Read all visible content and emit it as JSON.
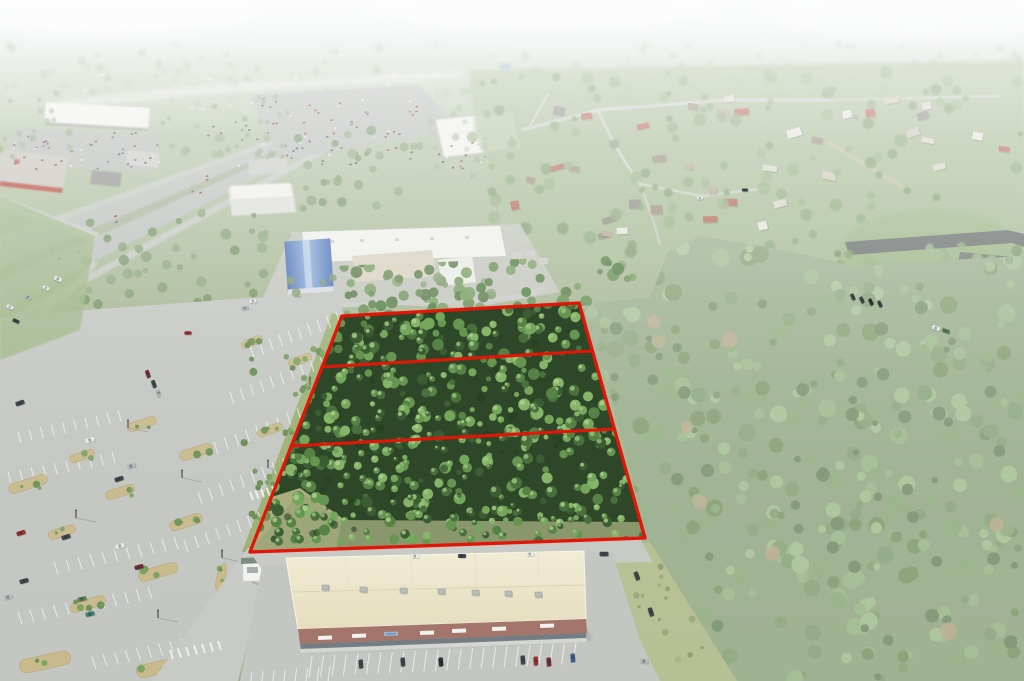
{
  "meta": {
    "kind": "aerial-drone-photograph",
    "subject": "wooded commercial land parcels outlined in red beside retail development and pine forest",
    "width_px": 1024,
    "height_px": 681,
    "parcel_count": 3
  },
  "palette": {
    "bg_sky": "#eef1f2",
    "bg_sky2": "#e6eaeb",
    "bg_dist": "#ccd6c5",
    "bg_mid": "#b2c2a5",
    "bg_green": "#a8b795",
    "bg_green2": "#a2b18d",
    "haze": "#ffffff",
    "city_white": "#e9eae6",
    "highway": "#bcc0bc",
    "median_green": "#a7b49a",
    "road_light": "#c7cac5",
    "lot": "#c3c6c1",
    "stripe": "#f0f2ef",
    "roof_white": "#eff0eb",
    "roof_gray": "#c9cbc6",
    "roof_dark": "#90928f",
    "bldg_mid": "#dcded8",
    "lowes_roof": "#c7c3ba",
    "lowes_red": "#b5483a",
    "blue_roof1": "#4f74b8",
    "blue_roof2": "#93b2dc",
    "school_taupe": "#d8d2c0",
    "apt_roof": "#6e7573",
    "apt_roof2": "#777e7b",
    "bldg_white": "#edeeea",
    "res_wash": "#a9bc97",
    "res_road": "#cbd0c8",
    "dirt_road": "#c4c0a4",
    "forest_base": "#8aa17a",
    "forest_dark": "#66815a",
    "forest_tan": "#b2a381",
    "parcel_base": "#2e4729",
    "parcel_dark": "#243c20",
    "clearing": "#a9ae7f",
    "clearing_dirt": "#c2bc95",
    "verge": "#9db177",
    "mulch": "#c9ba8e",
    "mulch_edge": "#b7a87c",
    "bush": "#6d8f54",
    "bush2": "#7ba15e",
    "scrub": "#b7c095",
    "grass": "#9cb786",
    "mall_roof_light": "#f2ecd6",
    "mall_roof_dark": "#e5ddbe",
    "mall_ridge": "#dcd3b2",
    "brick": "#a4756a",
    "storefront": "#6a747c",
    "sidewalk": "#d3d6d1",
    "sign_white": "#f2f2ee",
    "sign_roof": "#7c8a80",
    "shadow": "#8e938e",
    "pole": "#4a4f4a",
    "pole_shadow": "#8f948f",
    "hvac": "#b9bdb9"
  },
  "parcels": {
    "outline_color": "#e31507",
    "stroke_width": 3.3,
    "outline_points": "342,316 579,303 645,538 250,552",
    "divider1_points": "322,367 592,351",
    "divider2_points": "291,446 614,429",
    "band_clip_points": "322,318 332,266 648,254 662,302 580,306 342,316",
    "forest_clip_points": "577,312 600,302 650,298 668,252 700,236 772,248 852,266 908,262 1024,256 1024,681 737,681 648,543 630,470 607,380 585,340",
    "scrub_clip_points": "598,548 650,542 737,681 612,681"
  },
  "tree_palettes": {
    "hazy": [
      "#9db395",
      "#a6b89d",
      "#94ab8c"
    ],
    "upper": [
      "#8fa37f",
      "#97ab86",
      "#88a477"
    ],
    "mid": [
      "#7f9a6e",
      "#88a477",
      "#6d8f5c"
    ],
    "residential": [
      "#8aa678",
      "#93b081",
      "#7d9a6c"
    ],
    "band": [
      "#5e7f4d",
      "#6b8f58",
      "#7aa063",
      "#548047"
    ],
    "forest": [
      "#7d9a6c",
      "#85a473",
      "#92b07f",
      "#9cba88",
      "#74905f"
    ],
    "parcel": [
      "#3c5c33",
      "#49703c",
      "#568245",
      "#659551",
      "#74a65c",
      "#86b56a"
    ],
    "parcel_light": [
      "#9cc47d",
      "#aed28c"
    ],
    "scrub_dots": [
      "#9aa678",
      "#8f9c6d",
      "#a8b285"
    ]
  },
  "generated": {
    "seed": 7,
    "tree_regions": [
      {
        "layer": "trees-distant",
        "x": 0,
        "y": 44,
        "w": 1024,
        "h": 70,
        "n": 150,
        "rmin": 2,
        "rmax": 4.5,
        "pal": "hazy",
        "op": 0.5
      },
      {
        "layer": "trees-ul",
        "x": 150,
        "y": 92,
        "w": 140,
        "h": 65,
        "n": 28,
        "rmin": 2,
        "rmax": 4,
        "pal": "upper",
        "op": 0.75
      },
      {
        "layer": "trees-ul",
        "x": 0,
        "y": 92,
        "w": 70,
        "h": 70,
        "n": 16,
        "rmin": 2,
        "rmax": 4,
        "pal": "upper",
        "op": 0.75
      },
      {
        "layer": "trees-ul",
        "x": 420,
        "y": 108,
        "w": 100,
        "h": 70,
        "n": 15,
        "rmin": 2,
        "rmax": 4,
        "pal": "hazy",
        "op": 0.6
      },
      {
        "layer": "trees-mid",
        "x": 55,
        "y": 205,
        "w": 260,
        "h": 100,
        "n": 40,
        "rmin": 2.5,
        "rmax": 5.5,
        "pal": "mid",
        "op": 0.8
      },
      {
        "layer": "trees-mid",
        "x": 295,
        "y": 128,
        "w": 140,
        "h": 85,
        "n": 26,
        "rmin": 2.5,
        "rmax": 5,
        "pal": "mid",
        "op": 0.8
      },
      {
        "layer": "trees-school",
        "x": 245,
        "y": 275,
        "w": 320,
        "h": 45,
        "n": 26,
        "rmin": 3,
        "rmax": 6,
        "pal": "mid",
        "op": 0.85
      },
      {
        "layer": "trees-res",
        "x": 472,
        "y": 72,
        "w": 552,
        "h": 195,
        "n": 130,
        "rmin": 2.5,
        "rmax": 6.5,
        "pal": "residential",
        "op": 0.8
      },
      {
        "layer": "trees-apt",
        "x": 835,
        "y": 245,
        "w": 190,
        "h": 95,
        "n": 24,
        "rmin": 3,
        "rmax": 6,
        "pal": "forest",
        "op": 0.85
      },
      {
        "layer": "band-trees",
        "x": 325,
        "y": 258,
        "w": 330,
        "h": 60,
        "n": 80,
        "rmin": 3,
        "rmax": 6.5,
        "pal": "band",
        "op": 0.95
      },
      {
        "layer": "forest-trees",
        "x": 575,
        "y": 236,
        "w": 449,
        "h": 445,
        "n": 380,
        "rmin": 3.5,
        "rmax": 9,
        "pal": "forest",
        "op": 1
      },
      {
        "layer": "forest-trees",
        "x": 600,
        "y": 300,
        "w": 424,
        "h": 380,
        "n": 60,
        "rmin": 3,
        "rmax": 7,
        "pal": [
          "#66815a"
        ],
        "op": 0.9
      },
      {
        "layer": "forest-trees",
        "x": 640,
        "y": 300,
        "w": 384,
        "h": 360,
        "n": 8,
        "rmin": 5,
        "rmax": 9,
        "pal": [
          "#b2a381"
        ],
        "op": 0.8
      },
      {
        "layer": "verge-trees",
        "x": 240,
        "y": 330,
        "w": 100,
        "h": 215,
        "n": 16,
        "rmin": 2,
        "rmax": 4.5,
        "pal": [
          "#5f8449",
          "#6d9555"
        ],
        "op": 0.9
      },
      {
        "layer": "scrub-dots",
        "x": 598,
        "y": 548,
        "w": 150,
        "h": 130,
        "n": 45,
        "rmin": 1.5,
        "rmax": 3.5,
        "pal": "scrub_dots",
        "op": 0.9
      },
      {
        "layer": "parcel-trees",
        "x": 248,
        "y": 300,
        "w": 400,
        "h": 242,
        "n": 640,
        "rmin": 2.5,
        "rmax": 6,
        "pal": "parcel",
        "op": 1,
        "highlight": "parcel_light"
      }
    ],
    "city_specks": {
      "x": 55,
      "y": 72,
      "w": 380,
      "h": 45,
      "n": 26,
      "colors": [
        "#e9eae6",
        "#dfe0da",
        "#d4d6cf"
      ]
    },
    "lot_specks": [
      {
        "x": 10,
        "y": 130,
        "w": 148,
        "h": 40,
        "n": 55
      },
      {
        "x": 255,
        "y": 98,
        "w": 165,
        "h": 68,
        "n": 85
      },
      {
        "x": 425,
        "y": 132,
        "w": 88,
        "h": 36,
        "n": 26
      },
      {
        "x": 205,
        "y": 120,
        "w": 45,
        "h": 22,
        "n": 12
      }
    ],
    "speck_colors": [
      "#3f4345",
      "#b6babc",
      "#e9eae8",
      "#5b6065",
      "#993030"
    ],
    "traffic": {
      "n": 30,
      "x1": 8,
      "y1": 274,
      "x2": 400,
      "y2": 99,
      "spread": 14
    },
    "stripe_rows": [
      {
        "x1": 250,
        "y1": 346,
        "x2": 336,
        "y2": 312,
        "n": 10,
        "sx": 4,
        "sy": 12
      },
      {
        "x1": 230,
        "y1": 392,
        "x2": 330,
        "y2": 352,
        "n": 11,
        "sx": 4,
        "sy": 12
      },
      {
        "x1": 214,
        "y1": 442,
        "x2": 318,
        "y2": 400,
        "n": 11,
        "sx": 4,
        "sy": 12
      },
      {
        "x1": 198,
        "y1": 492,
        "x2": 304,
        "y2": 450,
        "n": 11,
        "sx": 4,
        "sy": 12
      },
      {
        "x1": 184,
        "y1": 540,
        "x2": 258,
        "y2": 512,
        "n": 8,
        "sx": 4,
        "sy": 12
      },
      {
        "x1": 18,
        "y1": 432,
        "x2": 118,
        "y2": 410,
        "n": 10,
        "sx": 3,
        "sy": 11
      },
      {
        "x1": 8,
        "y1": 472,
        "x2": 112,
        "y2": 452,
        "n": 10,
        "sx": 3,
        "sy": 11
      },
      {
        "x1": 54,
        "y1": 562,
        "x2": 174,
        "y2": 537,
        "n": 11,
        "sx": 4,
        "sy": 12
      },
      {
        "x1": 18,
        "y1": 612,
        "x2": 148,
        "y2": 587,
        "n": 12,
        "sx": 4,
        "sy": 12
      },
      {
        "x1": 92,
        "y1": 657,
        "x2": 214,
        "y2": 632,
        "n": 12,
        "sx": 4,
        "sy": 12
      },
      {
        "x1": 312,
        "y1": 656,
        "x2": 576,
        "y2": 643,
        "n": 24,
        "sx": -3,
        "sy": 21
      },
      {
        "x1": 252,
        "y1": 672,
        "x2": 330,
        "y2": 666,
        "n": 8,
        "sx": -2,
        "sy": 16
      }
    ],
    "crosswalks": [
      {
        "x1": 170,
        "y1": 650,
        "x2": 218,
        "y2": 641,
        "n": 7,
        "sx": 3,
        "sy": 9
      },
      {
        "x1": 250,
        "y1": 492,
        "x2": 272,
        "y2": 486,
        "n": 5,
        "sx": 3,
        "sy": 8
      },
      {
        "x1": 612,
        "y1": 638,
        "x2": 646,
        "y2": 633,
        "n": 6,
        "sx": 2,
        "sy": 8
      },
      {
        "x1": 412,
        "y1": 672,
        "x2": 428,
        "y2": 652,
        "n": 5,
        "sx": 9,
        "sy": 5
      },
      {
        "x1": 486,
        "y1": 670,
        "x2": 500,
        "y2": 650,
        "n": 5,
        "sx": 9,
        "sy": 5
      }
    ],
    "islands": [
      {
        "x": 142,
        "y": 424,
        "w": 30,
        "h": 9,
        "rot": -18
      },
      {
        "x": 196,
        "y": 452,
        "w": 34,
        "h": 10,
        "rot": -18
      },
      {
        "x": 82,
        "y": 456,
        "w": 26,
        "h": 8,
        "rot": -18
      },
      {
        "x": 28,
        "y": 484,
        "w": 40,
        "h": 10,
        "rot": -18
      },
      {
        "x": 120,
        "y": 492,
        "w": 30,
        "h": 9,
        "rot": -18
      },
      {
        "x": 186,
        "y": 522,
        "w": 34,
        "h": 10,
        "rot": -18
      },
      {
        "x": 62,
        "y": 532,
        "w": 28,
        "h": 9,
        "rot": -18
      },
      {
        "x": 158,
        "y": 572,
        "w": 40,
        "h": 11,
        "rot": -16
      },
      {
        "x": 88,
        "y": 604,
        "w": 36,
        "h": 10,
        "rot": -16
      },
      {
        "x": 45,
        "y": 662,
        "w": 52,
        "h": 14,
        "rot": -12
      },
      {
        "x": 158,
        "y": 668,
        "w": 44,
        "h": 13,
        "rot": -12
      },
      {
        "x": 234,
        "y": 618,
        "w": 30,
        "h": 10,
        "rot": -20
      },
      {
        "x": 270,
        "y": 430,
        "w": 26,
        "h": 8,
        "rot": -20
      },
      {
        "x": 300,
        "y": 360,
        "w": 24,
        "h": 8,
        "rot": -20
      },
      {
        "x": 252,
        "y": 342,
        "w": 22,
        "h": 8,
        "rot": -20
      },
      {
        "x": 205,
        "y": 628,
        "w": 9,
        "h": 30,
        "rot": 16
      },
      {
        "x": 221,
        "y": 577,
        "w": 8,
        "h": 28,
        "rot": 16
      },
      {
        "x": 583,
        "y": 658,
        "w": 22,
        "h": 12,
        "rot": 4
      }
    ],
    "bush_rows": [
      {
        "x": 300,
        "y": 390,
        "n": 5,
        "spread": 9
      },
      {
        "x": 285,
        "y": 430,
        "n": 4,
        "spread": 8
      },
      {
        "x": 268,
        "y": 480,
        "n": 4,
        "spread": 8
      },
      {
        "x": 256,
        "y": 515,
        "n": 4,
        "spread": 7
      },
      {
        "x": 318,
        "y": 350,
        "n": 4,
        "spread": 7
      },
      {
        "x": 316,
        "y": 648,
        "n": 3,
        "spread": 5
      },
      {
        "x": 340,
        "y": 647,
        "n": 3,
        "spread": 5
      },
      {
        "x": 365,
        "y": 646,
        "n": 3,
        "spread": 5
      },
      {
        "x": 390,
        "y": 645,
        "n": 3,
        "spread": 5
      },
      {
        "x": 415,
        "y": 644,
        "n": 3,
        "spread": 5
      },
      {
        "x": 440,
        "y": 643,
        "n": 3,
        "spread": 5
      },
      {
        "x": 465,
        "y": 642,
        "n": 3,
        "spread": 5
      },
      {
        "x": 490,
        "y": 641,
        "n": 3,
        "spread": 5
      },
      {
        "x": 515,
        "y": 640,
        "n": 3,
        "spread": 5
      },
      {
        "x": 540,
        "y": 639,
        "n": 3,
        "spread": 5
      },
      {
        "x": 560,
        "y": 638,
        "n": 3,
        "spread": 5
      }
    ],
    "poles": [
      {
        "x": 128,
        "y": 428
      },
      {
        "x": 182,
        "y": 478
      },
      {
        "x": 76,
        "y": 518
      },
      {
        "x": 158,
        "y": 618
      },
      {
        "x": 222,
        "y": 558
      },
      {
        "x": 310,
        "y": 385
      },
      {
        "x": 268,
        "y": 468
      },
      {
        "x": 254,
        "y": 602
      }
    ],
    "houses": {
      "regions": [
        {
          "x": 505,
          "y": 88,
          "w": 300,
          "h": 115,
          "n": 18
        },
        {
          "x": 812,
          "y": 96,
          "w": 200,
          "h": 78,
          "n": 12
        },
        {
          "x": 560,
          "y": 182,
          "w": 230,
          "h": 58,
          "n": 8
        }
      ],
      "colors": [
        "#e9e7e1",
        "#d9d6cd",
        "#cfc9ba",
        "#b6a795",
        "#9c8e7e",
        "#b5685a",
        "#8c8c84"
      ]
    }
  },
  "vehicles": {
    "car_colors": {
      "red": "#993030",
      "maroon": "#702f38",
      "dark": "#41464a",
      "black": "#2c2f33",
      "white": "#e9eae8",
      "silver": "#b6babc",
      "blue": "#3f5c8f",
      "teal": "#3f7f6e",
      "green": "#5d7f5a"
    },
    "cars": [
      {
        "x": 21,
        "y": 533,
        "a": -18,
        "c": "red"
      },
      {
        "x": 66,
        "y": 537,
        "a": -18,
        "c": "dark"
      },
      {
        "x": 120,
        "y": 546,
        "a": -15,
        "c": "white"
      },
      {
        "x": 139,
        "y": 567,
        "a": -15,
        "c": "maroon"
      },
      {
        "x": 24,
        "y": 581,
        "a": -15,
        "c": "dark"
      },
      {
        "x": 8,
        "y": 597,
        "a": -12,
        "c": "silver"
      },
      {
        "x": 82,
        "y": 599,
        "a": -14,
        "c": "green"
      },
      {
        "x": 90,
        "y": 614,
        "a": -14,
        "c": "teal"
      },
      {
        "x": 90,
        "y": 440,
        "a": -18,
        "c": "white"
      },
      {
        "x": 131,
        "y": 466,
        "a": -18,
        "c": "silver"
      },
      {
        "x": 119,
        "y": 479,
        "a": -18,
        "c": "dark"
      },
      {
        "x": 20,
        "y": 403,
        "a": -20,
        "c": "dark"
      },
      {
        "x": 148,
        "y": 374,
        "a": 70,
        "c": "maroon",
        "s": 0.9
      },
      {
        "x": 154,
        "y": 384,
        "a": 70,
        "c": "dark",
        "s": 0.9
      },
      {
        "x": 159,
        "y": 393,
        "a": 70,
        "c": "silver",
        "s": 0.9
      },
      {
        "x": 188,
        "y": 333,
        "a": 0,
        "c": "red",
        "s": 0.8
      },
      {
        "x": 10,
        "y": 307,
        "a": 25,
        "c": "white",
        "s": 0.8
      },
      {
        "x": 28,
        "y": 297,
        "a": 25,
        "c": "silver",
        "s": 0.8
      },
      {
        "x": 46,
        "y": 288,
        "a": 25,
        "c": "white",
        "s": 0.8
      },
      {
        "x": 16,
        "y": 321,
        "a": 25,
        "c": "dark",
        "s": 0.8
      },
      {
        "x": 58,
        "y": 279,
        "a": 25,
        "c": "white",
        "s": 0.9
      },
      {
        "x": 253,
        "y": 301,
        "a": -5,
        "c": "white",
        "s": 0.8
      },
      {
        "x": 245,
        "y": 308,
        "a": -5,
        "c": "silver",
        "s": 0.8
      },
      {
        "x": 415,
        "y": 556,
        "a": 0,
        "c": "white",
        "s": 0.9
      },
      {
        "x": 462,
        "y": 556,
        "a": 0,
        "c": "dark",
        "s": 0.9
      },
      {
        "x": 530,
        "y": 554,
        "a": 0,
        "c": "white",
        "s": 0.9
      },
      {
        "x": 604,
        "y": 554,
        "a": 0,
        "c": "dark"
      },
      {
        "x": 361,
        "y": 664,
        "a": 85,
        "c": "dark"
      },
      {
        "x": 403,
        "y": 662,
        "a": 85,
        "c": "dark"
      },
      {
        "x": 441,
        "y": 662,
        "a": 85,
        "c": "black"
      },
      {
        "x": 523,
        "y": 660,
        "a": 85,
        "c": "dark"
      },
      {
        "x": 536,
        "y": 661,
        "a": 85,
        "c": "red"
      },
      {
        "x": 549,
        "y": 662,
        "a": 85,
        "c": "maroon"
      },
      {
        "x": 573,
        "y": 658,
        "a": 85,
        "c": "blue"
      },
      {
        "x": 644,
        "y": 661,
        "a": 8,
        "c": "silver"
      },
      {
        "x": 637,
        "y": 576,
        "a": 70,
        "c": "dark"
      },
      {
        "x": 651,
        "y": 612,
        "a": 72,
        "c": "dark"
      },
      {
        "x": 853,
        "y": 297,
        "a": 65,
        "c": "dark",
        "s": 0.8
      },
      {
        "x": 862,
        "y": 300,
        "a": 65,
        "c": "dark",
        "s": 0.8
      },
      {
        "x": 871,
        "y": 302,
        "a": 65,
        "c": "black",
        "s": 0.8
      },
      {
        "x": 880,
        "y": 304,
        "a": 65,
        "c": "dark",
        "s": 0.8
      },
      {
        "x": 936,
        "y": 328,
        "a": 20,
        "c": "white",
        "s": 0.9
      },
      {
        "x": 946,
        "y": 331,
        "a": 20,
        "c": "green",
        "s": 0.9
      },
      {
        "x": 700,
        "y": 198,
        "a": 0,
        "c": "white",
        "s": 0.7
      },
      {
        "x": 745,
        "y": 190,
        "a": 0,
        "c": "dark",
        "s": 0.7
      }
    ]
  }
}
